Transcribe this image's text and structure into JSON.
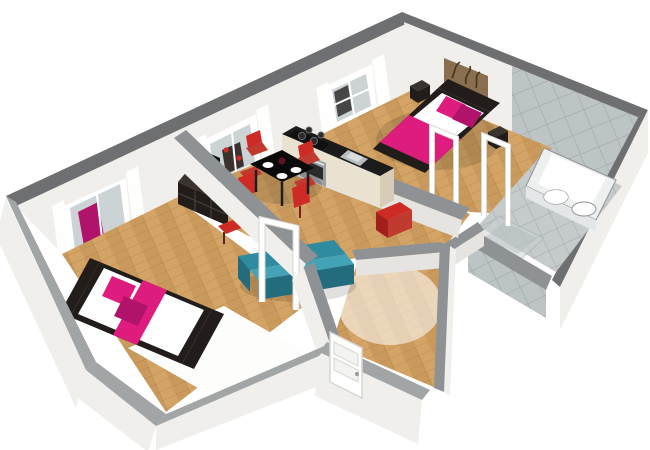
{
  "scene": {
    "type": "3d-floor-plan-render",
    "rooms": [
      {
        "id": "bedroom-left",
        "contents": [
          "double-bed-magenta",
          "white-rug",
          "window-reflecting-bed"
        ]
      },
      {
        "id": "living-dining",
        "contents": [
          "tv-unit",
          "tv",
          "red-bench",
          "dining-table",
          "red-chairs-x4",
          "plates",
          "teal-sofa",
          "window-reflecting-dining"
        ]
      },
      {
        "id": "kitchen",
        "contents": [
          "cream-cabinets",
          "black-countertop",
          "oven",
          "cooktop",
          "sink"
        ]
      },
      {
        "id": "bedroom-top",
        "contents": [
          "double-bed-magenta",
          "nightstand-x2",
          "wall-art-branches",
          "window-with-curtains"
        ]
      },
      {
        "id": "bathroom",
        "contents": [
          "bathtub",
          "twin-basins",
          "glass-shower",
          "toilet",
          "grey-tiles"
        ]
      },
      {
        "id": "entrance-hall",
        "contents": [
          "front-door-white",
          "red-ottoman"
        ]
      }
    ],
    "open_door_frames": 3
  },
  "palette": {
    "bg": "#ffffff",
    "wall_face": "#f0efec",
    "wall_face_shade": "#e6e4e0",
    "wall_face_dim": "#dddbd6",
    "cap_dark": "#6d6f70",
    "cap_mid": "#8f9294",
    "cap_light": "#a2a5a6",
    "floor_a": "#d3a466",
    "floor_b": "#c08f52",
    "floor_line": "#a1773f",
    "rug": "#fdfdfc",
    "tile_floor": "#c5cacb",
    "tile_line": "#a8afb1",
    "tile_wall": "#bdc4c6",
    "tile_wall_line": "#9fa7a9",
    "glass": "#ccd3d5",
    "glass_frame": "#aab4b2",
    "white": "#ffffff",
    "door_edge": "#d6d6d2",
    "door_panel": "#f3f3f0",
    "magenta": "#dd1c7e",
    "magenta_dark": "#b2136a",
    "red": "#cf2b25",
    "red_mid": "#c03a30",
    "red_dark": "#a31f1b",
    "teal": "#2e8ba0",
    "teal_light": "#43a2b6",
    "teal_dark": "#236c7d",
    "furn_black": "#221d1a",
    "furn_black2": "#3a342f",
    "tv_black": "#0a0a0a",
    "cubby_line": "#4a433d",
    "cream": "#e9e2d0",
    "cream_dark": "#d7cdb6",
    "counter": "#1b1b1b",
    "steel": "#b9bdbf",
    "steel_dark": "#8e9396",
    "oven_steel": "#9aa0a3",
    "art": "#8a6e50",
    "art_dark": "#43361f",
    "reflection_dark": "#3b322e",
    "shadow": "rgba(0,0,0,0.12)"
  }
}
